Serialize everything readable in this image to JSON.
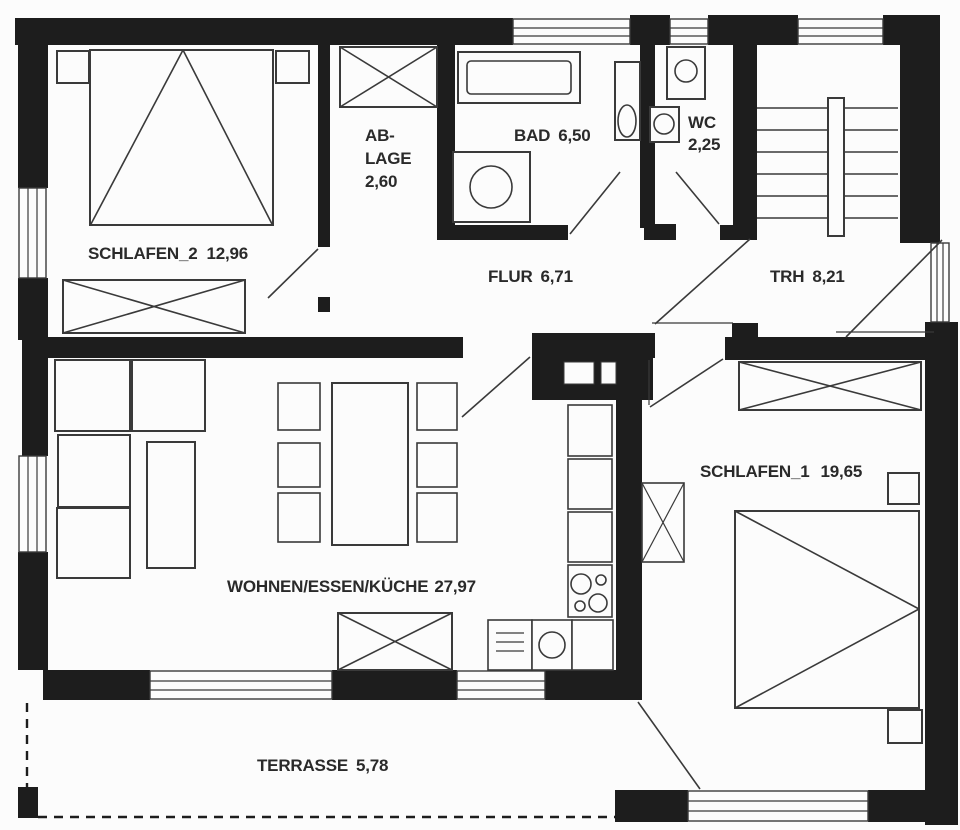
{
  "title": "Apartment floor plan",
  "rooms": {
    "schlafen2": {
      "name": "SCHLAFEN_2",
      "area": "12,96"
    },
    "ablage": {
      "name_line1": "AB-",
      "name_line2": "LAGE",
      "area": "2,60"
    },
    "bad": {
      "name": "BAD",
      "area": "6,50"
    },
    "wc": {
      "name": "WC",
      "area": "2,25"
    },
    "flur": {
      "name": "FLUR",
      "area": "6,71"
    },
    "trh": {
      "name": "TRH",
      "area": "8,21"
    },
    "schlafen1": {
      "name": "SCHLAFEN_1",
      "area": "19,65"
    },
    "wohnen": {
      "name": "WOHNEN/ESSEN/KÜCHE",
      "area": "27,97"
    },
    "terrasse": {
      "name": "TERRASSE",
      "area": "5,78"
    }
  },
  "colors": {
    "wall": "#1d1d1d",
    "stroke": "#3a3a3a",
    "text": "#2a2a2a",
    "background": "#fcfcfc"
  }
}
